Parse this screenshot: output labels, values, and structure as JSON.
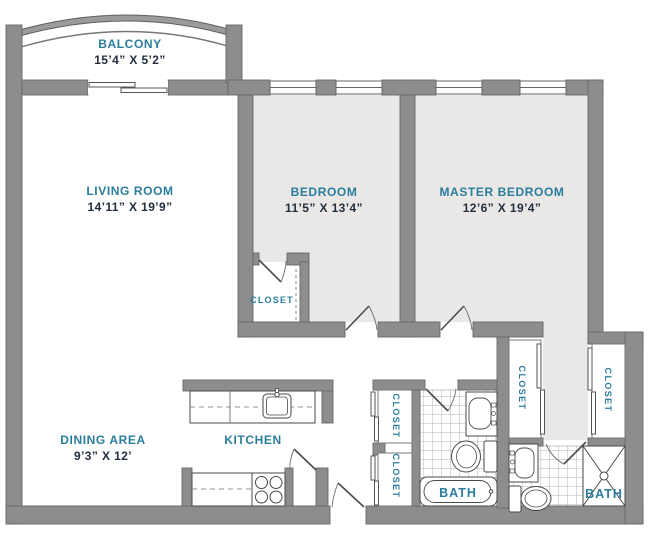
{
  "plan": {
    "type": "apartment-floor-plan",
    "rooms": {
      "balcony": {
        "label": "BALCONY",
        "dims": "15’4” X 5’2”"
      },
      "living_room": {
        "label": "LIVING ROOM",
        "dims": "14’11” X 19’9”"
      },
      "bedroom": {
        "label": "BEDROOM",
        "dims": "11’5” X 13’4”"
      },
      "master_bedroom": {
        "label": "MASTER BEDROOM",
        "dims": "12’6” X 19’4”"
      },
      "dining_area": {
        "label": "DINING AREA",
        "dims": "9’3” X 12’"
      },
      "kitchen": {
        "label": "KITCHEN"
      },
      "bedroom_closet": {
        "label": "CLOSET"
      },
      "hall_closet_upper": {
        "label": "CLOSET"
      },
      "hall_closet_lower": {
        "label": "CLOSET"
      },
      "master_closet_left": {
        "label": "CLOSET"
      },
      "master_closet_right": {
        "label": "CLOSET"
      },
      "hall_bath": {
        "label": "BATH"
      },
      "master_bath": {
        "label": "BATH"
      }
    },
    "colors": {
      "room_label": "#2a7d9c",
      "dimension_text": "#232f3f",
      "wall": "#8d8d8d",
      "shaded_floor": "#e9e8e6"
    }
  }
}
